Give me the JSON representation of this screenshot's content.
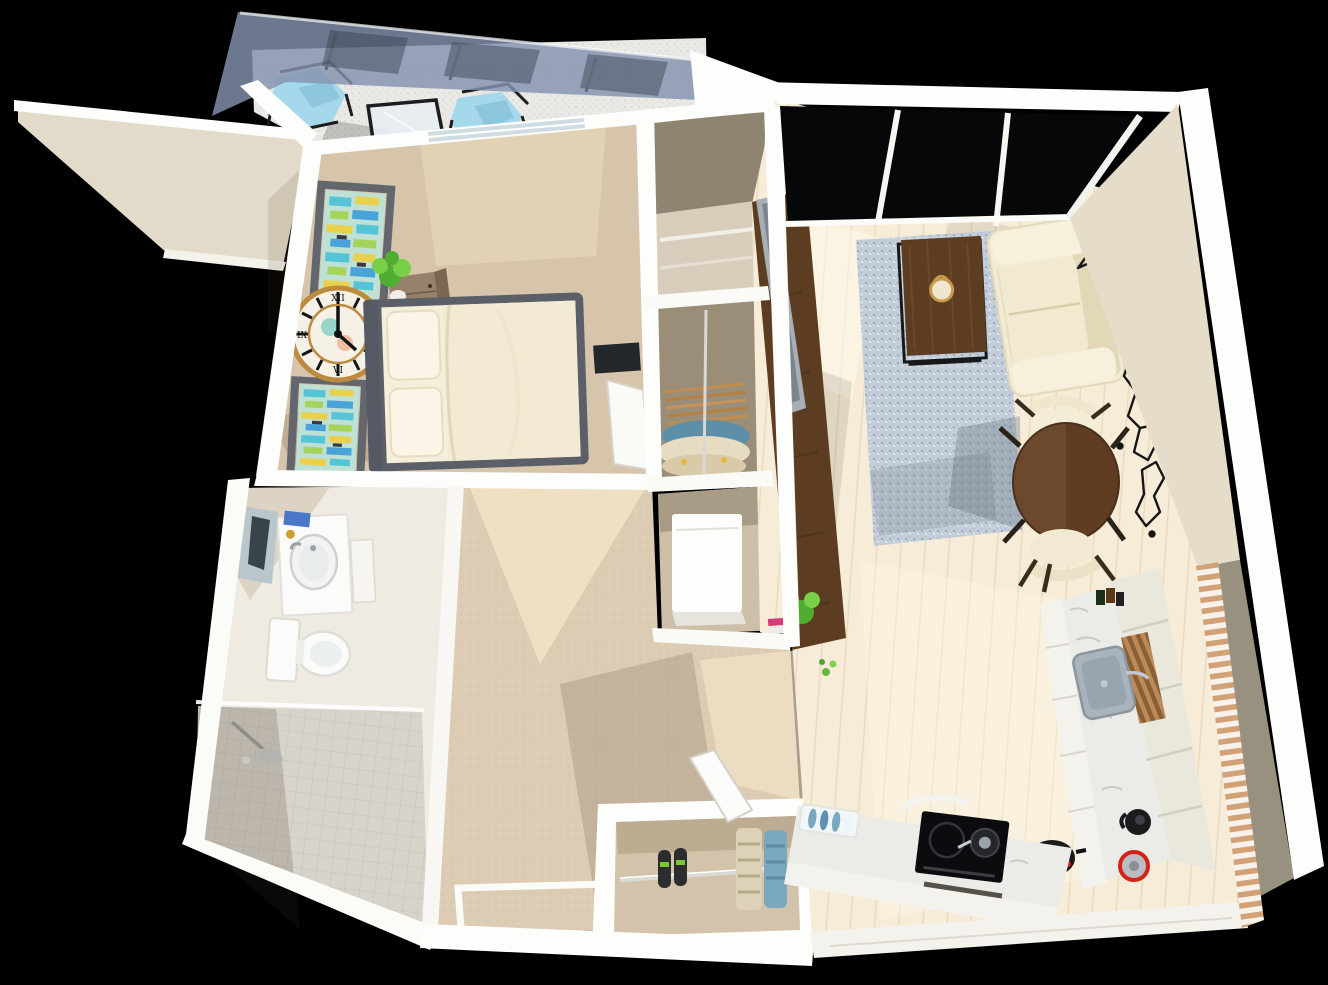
{
  "meta": {
    "description": "3D rendered top-down dollhouse view of a one-bedroom apartment floor plan on a black background",
    "view": "aerial perspective, slightly rotated",
    "canvas": {
      "width": 1328,
      "height": 985
    }
  },
  "rooms": [
    {
      "id": "balcony",
      "label": "balcony with glass canopy"
    },
    {
      "id": "bedroom",
      "label": "bedroom"
    },
    {
      "id": "walk-in-closet",
      "label": "wardrobe closet"
    },
    {
      "id": "utility-closet",
      "label": "utility closet with washer"
    },
    {
      "id": "bathroom",
      "label": "bathroom with walk-in shower"
    },
    {
      "id": "hallway",
      "label": "hallway"
    },
    {
      "id": "entry-closet",
      "label": "entry shoe closet"
    },
    {
      "id": "living-room",
      "label": "living room"
    },
    {
      "id": "dining-area",
      "label": "dining nook"
    },
    {
      "id": "kitchen",
      "label": "L-shaped kitchen"
    }
  ],
  "furniture": [
    "two blue sling chairs",
    "glass patio table",
    "double bed with gray frame",
    "nightstand with plant",
    "roman numeral wall clock",
    "two abstract art frames",
    "wardrobe with hanging clothes",
    "washing machine",
    "vanity sink with mirror",
    "toilet",
    "rain shower",
    "shoe rack with sneakers and hanging organizers",
    "cream loveseat sofa",
    "blue speckled rug",
    "dark wood coffee table",
    "TV on dark media cabinet",
    "geometric black wall map",
    "round dining table",
    "two cream dining chairs",
    "induction cooktop with pot",
    "kitchen sink",
    "kettle and pots",
    "dish rack with blue plates"
  ],
  "clock": {
    "numerals": [
      "XII",
      "III",
      "VI",
      "IX"
    ]
  },
  "palette": {
    "background": "#000000",
    "wall_white": "#fdfdfb",
    "wall_cream": "#e9e2d1",
    "wall_face": "#e5ddc9",
    "wall_shadow_face": "#99917f",
    "slab_face": "#e2dbc9",
    "bedroom_carpet": "#d6c5ab",
    "bedroom_sunlight": "#ecdcbd",
    "hall_carpet": "#dcccb3",
    "hall_sunlight": "#f2e3c7",
    "living_floor": "#f7ecd7",
    "plank_line": "#e9d9bc",
    "balcony_floor": "#e9e9e5",
    "canopy_glass": "#8293ae",
    "window_glass": "#060709",
    "glass_table": "#e6edf2",
    "rug_base": "#c3ceda",
    "rug_speck": "#8fa2b5",
    "sofa_cream": "#f2ebd4",
    "sofa_shade": "#e2d7b6",
    "wood_dark": "#5d3d22",
    "wood_grain": "#6e4b2a",
    "table_wood": "#5f3c22",
    "table_sheen": "#6f4b2e",
    "clock_gold": "#bd8b3e",
    "clock_face": "#f5f1e6",
    "frame_gray": "#63666c",
    "art_base": "#bfe0d5",
    "art_teal": "#55c4d6",
    "art_green": "#a5d45c",
    "art_yellow": "#e9d14b",
    "art_blue": "#4aa3d8",
    "bed_frame": "#5b5f68",
    "mattress_cream": "#f5eedb",
    "pillow_cream": "#faf5e6",
    "chair_blue": "#a6d8ec",
    "metal_black": "#1b1b1d",
    "marble": "#ebebe8",
    "cabinet_white": "#f3f2ed",
    "cabinet_cream": "#eae8dc",
    "cooktop_black": "#0c0c0e",
    "sink_steel": "#a9b3bc",
    "appliance_red": "#d42316",
    "plant_green": "#4fae2f",
    "plant_light": "#79cf48",
    "hanger_tan": "#c28c4f",
    "clothes_blue": "#5e8fa8",
    "clothes_cream": "#e7dcc2",
    "washer_white": "#fdfdfc",
    "shoe_black": "#2d2d30",
    "organizer_cream": "#ddd2b7",
    "organizer_blue": "#7aa8c0",
    "map_art_black": "#161616",
    "slat_tan": "#d2a276",
    "slat_light": "#f7f3ec",
    "mirror_glass": "#b9c6cc",
    "mirror_dark": "#39434a",
    "towel_blue": "#4a78c8",
    "book_pink": "#d23c78",
    "shower_tile": "#d8d4cb",
    "bath_tile": "#efeae2",
    "toilet_white": "#fbfbfa",
    "shadow_tint": "rgba(70,52,32,0.16)"
  }
}
